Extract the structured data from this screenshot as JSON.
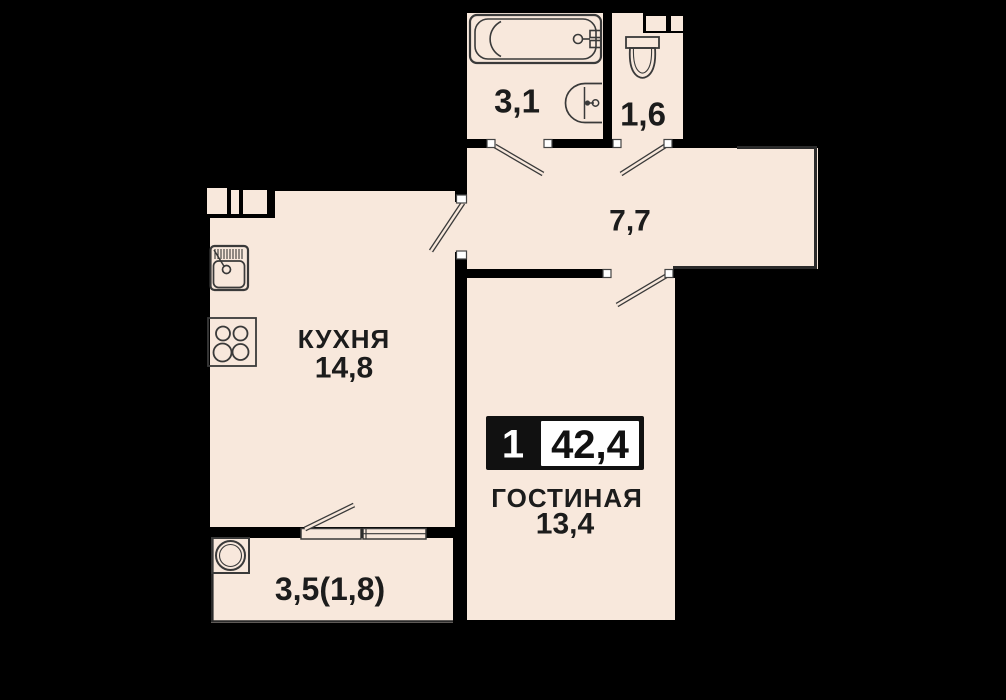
{
  "plan": {
    "title": "apartment-floor-plan",
    "badge": {
      "rooms_count": "1",
      "total_area": "42,4"
    },
    "rooms": {
      "bathroom": {
        "area": "3,1"
      },
      "toilet": {
        "area": "1,6"
      },
      "hallway": {
        "area": "7,7"
      },
      "kitchen": {
        "name": "КУХНЯ",
        "area": "14,8"
      },
      "living_room": {
        "name": "ГОСТИНАЯ",
        "area": "13,4"
      },
      "balcony": {
        "area": "3,5(1,8)"
      }
    },
    "fixtures": {
      "bathroom": [
        "bathtub-icon",
        "sink-icon"
      ],
      "toilet": [
        "toilet-icon"
      ],
      "kitchen": [
        "kitchen-sink-icon",
        "stove-icon"
      ],
      "balcony": [
        "washing-machine-icon"
      ]
    },
    "colors": {
      "background": "#000000",
      "floor": "#f8e8dc",
      "wall": "#000000",
      "fixture_line": "#3a3a3a",
      "thin_wall": "#2b2b2b",
      "text": "#1c1c1c",
      "badge_bg": "#111111",
      "badge_value_bg": "#ffffff"
    }
  }
}
